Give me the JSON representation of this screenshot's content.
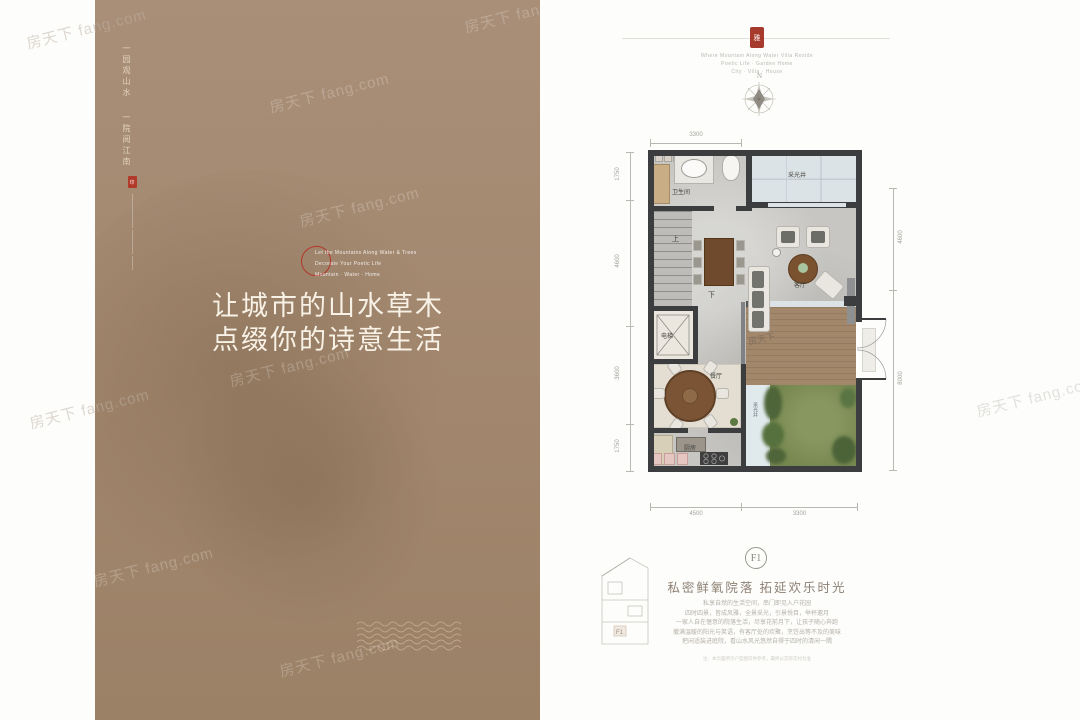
{
  "watermark": {
    "text": "房天下 fang.com",
    "short": "房天下"
  },
  "left": {
    "tagline_a": "一园观山水",
    "tagline_b": "一院阅江南",
    "seal_char": "印",
    "note1": "Let the Mountains Along Water & Trees",
    "note2": "Decorate Your Poetic Life",
    "note3": "Mountain · Water · Home",
    "headline1": "让城市的山水草木",
    "headline2": "点缀你的诗意生活"
  },
  "header": {
    "seal_char": "雅",
    "caption1": "Where Mountain Along Water Villa Reside",
    "caption2": "Poetic Life · Garden Home",
    "caption3": "City · Villa · House",
    "compass_n": "N"
  },
  "rooms": {
    "bath": "卫生间",
    "skylight": "采光井",
    "living": "客厅",
    "elevator": "电梯",
    "dining": "餐厅",
    "kitchen": "厨房",
    "skylight_side": "采光井",
    "up": "上",
    "down": "下"
  },
  "dims": {
    "top": "3300",
    "l1": "1750",
    "l2": "4600",
    "l3": "3600",
    "l4": "1750",
    "r1": "4600",
    "r2": "8000",
    "b1": "4500",
    "b2": "3300"
  },
  "f1": {
    "badge": "F1",
    "thumb_label": "F1",
    "title": "私密鲜氧院落 拓延欢乐时光",
    "p1": "私享自然的生活空间，串门即见入户花园",
    "p2": "四时四景，皆成风雅，全景采光，引景悦目，举杯邀月",
    "p3": "一家人自在惬意的院落生活，尽享花前月下，让孩子随心奔跑",
    "p4": "撒满温暖的阳光与笑语，有客厅处的欢聚，烹饪出等不及的美味",
    "p5": "把闲适装进庭院，看山水风光悠然自得于四时的清闲一隅",
    "disclaimer": "注：本页面所示户型图仅供参考，最终以实际交付为准"
  }
}
